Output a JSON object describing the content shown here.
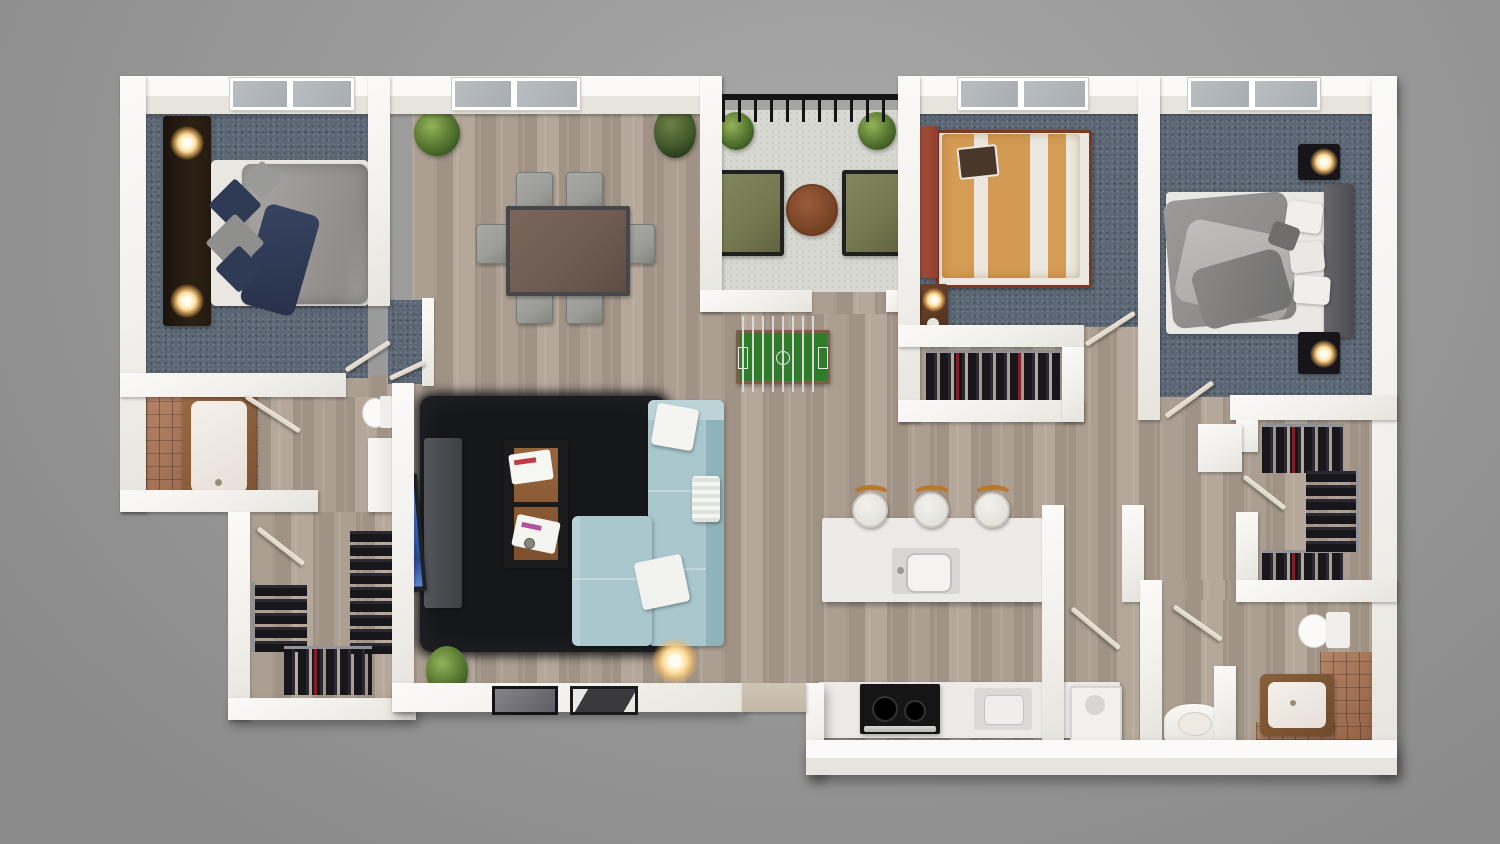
{
  "scene": {
    "title": "Photorealistic top-down 3D floor plan render of a 3-bedroom apartment",
    "view": "top-down dollhouse",
    "background": "gray studio backdrop"
  },
  "palette": {
    "bg1": "#a9a9a9",
    "bg2": "#8b8b8b",
    "wall1": "#fbfaf8",
    "wall2": "#e7e4de",
    "wood1": "#ac9f92",
    "wood2": "#a09386",
    "wood3": "#b5a89a",
    "carpet": "#5b6774",
    "balcony": "#d8d8d2",
    "tile": "#a76f4e",
    "rug": "#16171a",
    "sofa": "#a9c7cd",
    "sofadark": "#8fb3ba",
    "sofalight": "#bcd3d7",
    "olive": "#767950",
    "tablewood": "#6e5b51",
    "chair": "#9c9c98",
    "marble": "#edebe8",
    "duvetgray": "#9b9895",
    "navy": "#2f3a54",
    "orange": "#d59c55",
    "leather": "#913f2c",
    "darkfurn": "#17151a",
    "glowcol": "#ffdf9e",
    "doorleaf": "#d9d0c2",
    "screen": "#3a6cc8",
    "field": "#2f7d2b",
    "stoolwood": "#b5792f",
    "threshold": "#cfc5b5"
  },
  "rooms": [
    {
      "name": "Bedroom 1 (top-left)",
      "floor": "blue-gray carpet",
      "furniture": [
        "double bed, gray duvet, navy and gray pillows",
        "dark wood headboard wall with two lit lamps",
        "window"
      ]
    },
    {
      "name": "Ensuite bathroom (left)",
      "floor": "terracotta tile and wood",
      "furniture": [
        "bathtub with wood surround",
        "toilet",
        "shower / vanity unit"
      ]
    },
    {
      "name": "Walk-in closet (bottom-left)",
      "floor": "wood",
      "furniture": [
        "three hanging clothes racks"
      ]
    },
    {
      "name": "Living and dining room (center)",
      "floor": "wood planks",
      "furniture": [
        "dining table with six gray chairs",
        "black shag rug",
        "light-blue L-shaped sectional sofa with white pillows",
        "TV on dark media cabinet",
        "coffee table with magazines",
        "lit floor lamp",
        "potted plants",
        "two flat picture frames on bottom ledge"
      ]
    },
    {
      "name": "Balcony (top-center)",
      "floor": "concrete",
      "furniture": [
        "two olive-green armchairs",
        "round wooden side table",
        "two potted plants",
        "black metal railing"
      ]
    },
    {
      "name": "Hall games nook (center)",
      "floor": "wood planks",
      "furniture": [
        "foosball table with green pitch"
      ]
    },
    {
      "name": "Bedroom 2 (top middle-right)",
      "floor": "blue-gray carpet",
      "furniture": [
        "double bed with orange and white striped duvet",
        "rust leather headboard",
        "nightstand with lit lamp",
        "window",
        "closet nook with hanging clothes"
      ]
    },
    {
      "name": "Bedroom 3 (top-right)",
      "floor": "blue-gray carpet",
      "furniture": [
        "double bed with rumpled gray duvet",
        "gray upholstered headboard",
        "two black nightstands with lit lamps",
        "window"
      ]
    },
    {
      "name": "Walk-in closet (right)",
      "floor": "wood",
      "furniture": [
        "three hanging clothes racks"
      ]
    },
    {
      "name": "Kitchen (bottom-center)",
      "floor": "wood planks",
      "furniture": [
        "white marble island with sink",
        "three bar stools with wood backs",
        "counter run with black cooktop range and cabinets"
      ]
    },
    {
      "name": "Laundry (bottom center-right)",
      "floor": "wood",
      "furniture": [
        "washing machine"
      ]
    },
    {
      "name": "Bathroom 2 (bottom-right)",
      "floor": "wood and terracotta tile",
      "furniture": [
        "toilet",
        "bathtub with wood surround",
        "vanity sink with towel rail"
      ]
    }
  ]
}
